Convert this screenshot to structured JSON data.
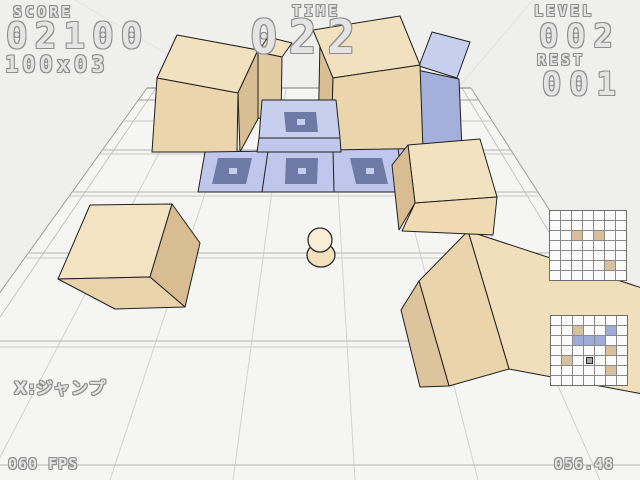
{
  "hud": {
    "score": {
      "label": "SCORE",
      "value": "02100",
      "sub": "100x03"
    },
    "time": {
      "label": "TIME",
      "value": "022"
    },
    "level": {
      "label": "LEVEL",
      "value": "002"
    },
    "rest": {
      "label": "REST",
      "value": "001"
    },
    "hint": "X:ジャンプ",
    "fps": "060 FPS",
    "timer_detail": "056.48"
  },
  "palette": {
    "background": "#efefed",
    "floor": "#f5f5f3",
    "grid_minor": "#d2d2d0",
    "grid_major": "#b4b4b2",
    "rim": "#9e9e9c",
    "back_edge": "#7e7e7c",
    "cube_edge": "#1f1f1f",
    "tan_top": "#f2e1be",
    "tan_front": "#ebd5ac",
    "tan_side": "#d9be94",
    "blue_top": "#c7cfee",
    "blue_front": "#bfc8ec",
    "blue_side": "#a5afdc",
    "marker_dark": "#6e79a6",
    "marker_dot": "#c6ceee",
    "hud_fill": "#e4e4e4",
    "hud_outline": "#8e8e8e",
    "minimap_tan": "#d9c09c",
    "minimap_blue": "#9fabd8"
  },
  "stage": {
    "grid_cols": 7,
    "grid_rows": 7,
    "objects": [
      {
        "type": "tower-2high",
        "color": "tan",
        "pos": "back-left"
      },
      {
        "type": "tower-2high",
        "color": "tan",
        "pos": "behind-back-left"
      },
      {
        "type": "tower-2high",
        "color": "tan",
        "pos": "back-center-right"
      },
      {
        "type": "tower-2high",
        "color": "blue",
        "pos": "back-right"
      },
      {
        "type": "cube",
        "color": "blue",
        "marker": "top",
        "pos": "center-raised"
      },
      {
        "type": "cube-row",
        "color": "blue",
        "markers": 3,
        "pos": "middle-row"
      },
      {
        "type": "cube",
        "color": "tan",
        "pos": "mid-right"
      },
      {
        "type": "cube",
        "color": "tan",
        "state": "rolling",
        "pos": "mid-left"
      },
      {
        "type": "cube-large",
        "color": "tan",
        "state": "rolling",
        "pos": "front-right"
      },
      {
        "type": "player-ball",
        "pos": "front-center"
      }
    ]
  },
  "minimaps": {
    "rows": 7,
    "cols": 7,
    "maps": [
      {
        "id": "upper",
        "cells": [
          {
            "r": 2,
            "c": 2,
            "t": "tan"
          },
          {
            "r": 2,
            "c": 4,
            "t": "tan"
          },
          {
            "r": 5,
            "c": 5,
            "t": "tan"
          }
        ]
      },
      {
        "id": "lower",
        "cells": [
          {
            "r": 1,
            "c": 2,
            "t": "tan"
          },
          {
            "r": 1,
            "c": 5,
            "t": "blue"
          },
          {
            "r": 2,
            "c": 2,
            "t": "blue"
          },
          {
            "r": 2,
            "c": 3,
            "t": "blue"
          },
          {
            "r": 2,
            "c": 4,
            "t": "blue"
          },
          {
            "r": 3,
            "c": 5,
            "t": "tan"
          },
          {
            "r": 4,
            "c": 1,
            "t": "tan"
          },
          {
            "r": 4,
            "c": 3,
            "t": "player"
          },
          {
            "r": 5,
            "c": 5,
            "t": "tan"
          }
        ]
      }
    ]
  }
}
